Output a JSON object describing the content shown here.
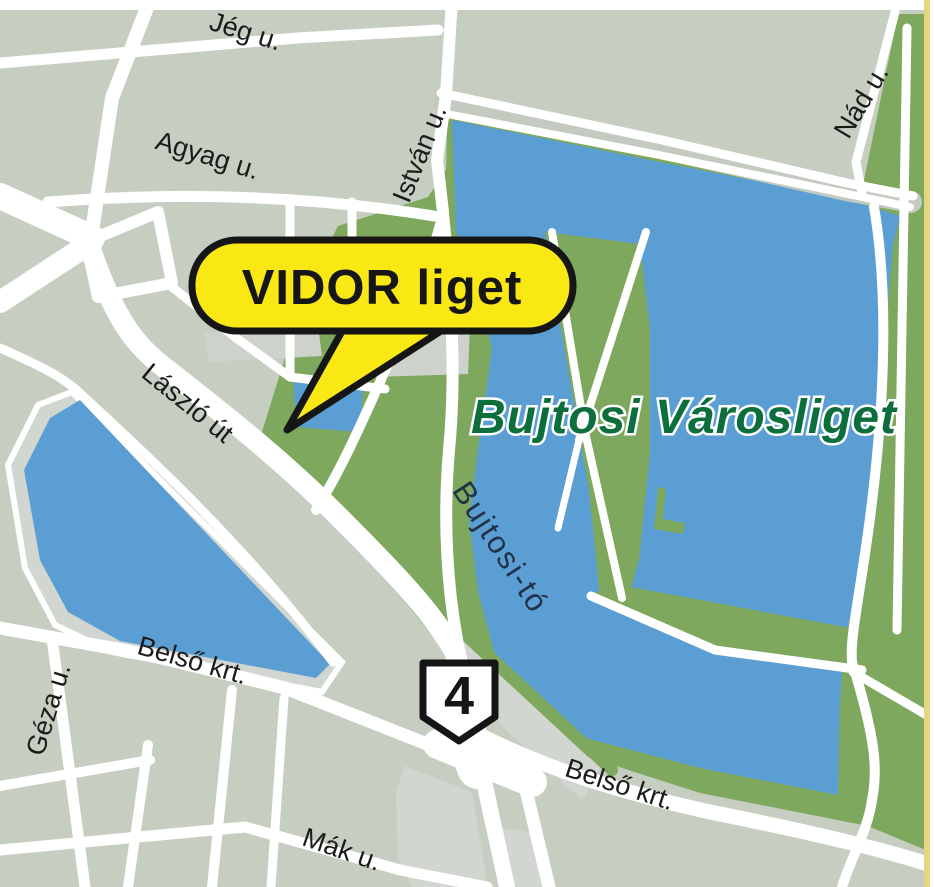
{
  "map": {
    "title": "VIDOR liget location map",
    "callout": {
      "text": "VIDOR liget"
    },
    "route_shield": {
      "number": "4"
    },
    "region_labels": {
      "park_title": "Bujtosi Városliget",
      "lake": "Bujtosi-tó"
    },
    "streets": {
      "jeg": "Jég u.",
      "agyag": "Agyag u.",
      "istvan": "István u.",
      "nad": "Nád u.",
      "laszlo": "László út",
      "geza": "Géza u.",
      "belso_w": "Belső krt.",
      "belso_se": "Belső krt.",
      "mak": "Mák u."
    },
    "colors": {
      "background": "#c6cdc1",
      "block": "#cdd2cb",
      "block_light": "#d2d6d0",
      "park": "#7ea85e",
      "water": "#5b9ed4",
      "road": "#ffffff",
      "road_median": "#c3cabf",
      "callout_fill": "#f9e814",
      "outline": "#161616",
      "park_label": "#0c6e3c",
      "water_label": "#223048",
      "street_label": "#1b1b1b",
      "border_line": "#e3d67c"
    }
  }
}
